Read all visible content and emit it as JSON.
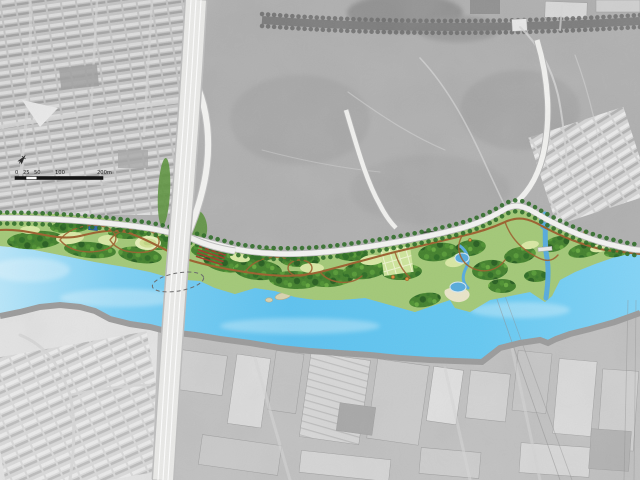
{
  "map": {
    "title": "Riverfront park landscape masterplan over grayscale aerial photo",
    "scale_bar": {
      "labels": [
        "0",
        "25",
        "50",
        "100",
        "200m"
      ]
    },
    "north_arrow": {
      "glyph": "compass-needle"
    },
    "colors": {
      "aerial_base": "#b0b0b0",
      "residential_block": "#c6c6c6",
      "industrial_base": "#c2c2c2",
      "river_blue": "#5ec2ef",
      "pond_blue": "#58abdc",
      "small_pond_dark": "#2e68a6",
      "park_green": "#a3c878",
      "canopy_green": "#44812e",
      "lawn_green": "#d8e7a4",
      "path_brown": "#9c612f",
      "road_white": "#f2f2f0",
      "highway_deck": "#e9e9e7",
      "south_bank_gray": "#9b9b9b",
      "island_tan": "#d8d2ae",
      "terrace_red": "#a03c2a"
    },
    "regions": [
      {
        "id": "residential-northwest"
      },
      {
        "id": "open-field-northeast"
      },
      {
        "id": "riverfront-park"
      },
      {
        "id": "river"
      },
      {
        "id": "industrial-south"
      },
      {
        "id": "residential-southwest"
      },
      {
        "id": "elevated-highway-bridge"
      },
      {
        "id": "park-edge-road"
      }
    ]
  }
}
